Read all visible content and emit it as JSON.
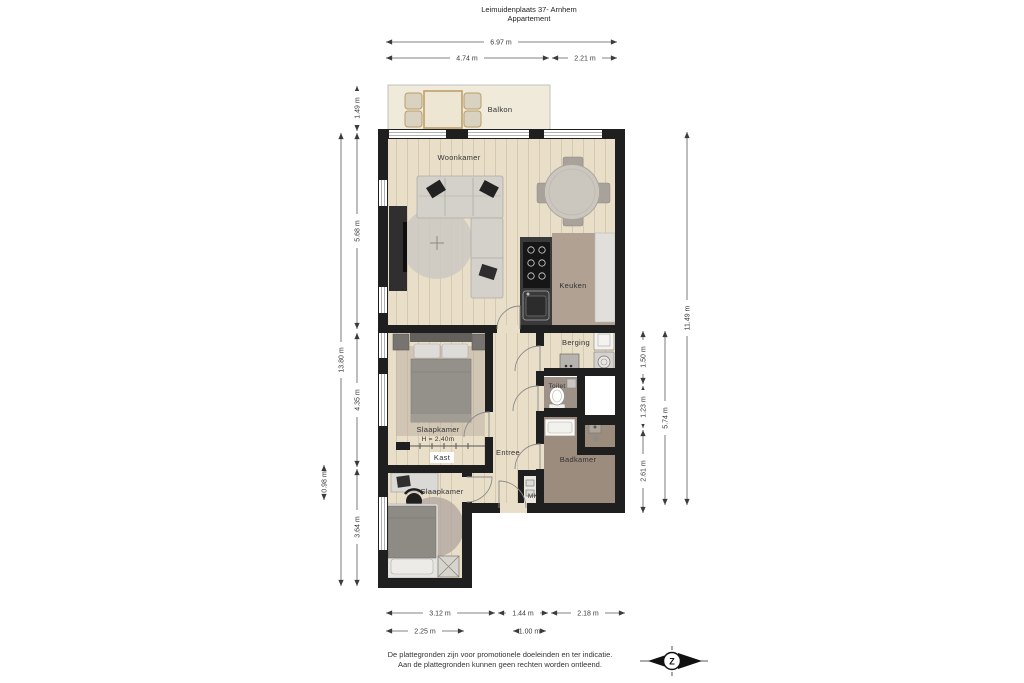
{
  "title": {
    "line1": "Leimuidenplaats 37- Arnhem",
    "line2": "Appartement"
  },
  "rooms": {
    "balkon": "Balkon",
    "woonkamer": "Woonkamer",
    "keuken": "Keuken",
    "berging": "Berging",
    "toilet": "Toilet",
    "slaapkamer_1": "Slaapkamer",
    "slaapkamer_1_height": "H = 2.40m",
    "kast": "Kast",
    "entree": "Entree",
    "badkamer": "Badkamer",
    "mk": "MK",
    "slaapkamer_2": "Slaapkamer"
  },
  "dimensions": {
    "top_total": "6.97 m",
    "top_left": "4.74 m",
    "top_right": "2.21 m",
    "left_balkon": "1.49 m",
    "left_woonkamer": "5.68 m",
    "left_total": "13.80 m",
    "left_slaapkamer1": "4.35 m",
    "left_kast": "0.98 m",
    "left_slaapkamer2": "3.64 m",
    "right_total": "11.49 m",
    "right_middle": "5.74 m",
    "right_berging": "1.50 m",
    "right_toilet": "1.23 m",
    "right_badkamer": "2.61 m",
    "bottom_row1_left": "3.12 m",
    "bottom_row1_mid": "1.44 m",
    "bottom_row1_right": "2.18 m",
    "bottom_row2_left": "2.25 m",
    "bottom_row2_mid": "1.00 m"
  },
  "footer": {
    "disclaimer_line1": "De plattegronden zijn voor promotionele doeleinden en ter indicatie.",
    "disclaimer_line2": "Aan de plattegronden kunnen geen rechten worden ontleend.",
    "compass_label": "Z"
  },
  "colors": {
    "wall": "#1f1f1f",
    "wood_floor": "#e9dfc9",
    "balcony_floor": "#efead9",
    "kitchen_floor": "#b1a192",
    "counter_dark": "#3a3a3a",
    "counter_light": "#e1dfdc",
    "toilet_floor": "#9d9188",
    "bathroom_floor": "#9c8c7e",
    "furniture_gray": "#d4d1cb",
    "accent_tan": "#bfa06a"
  }
}
